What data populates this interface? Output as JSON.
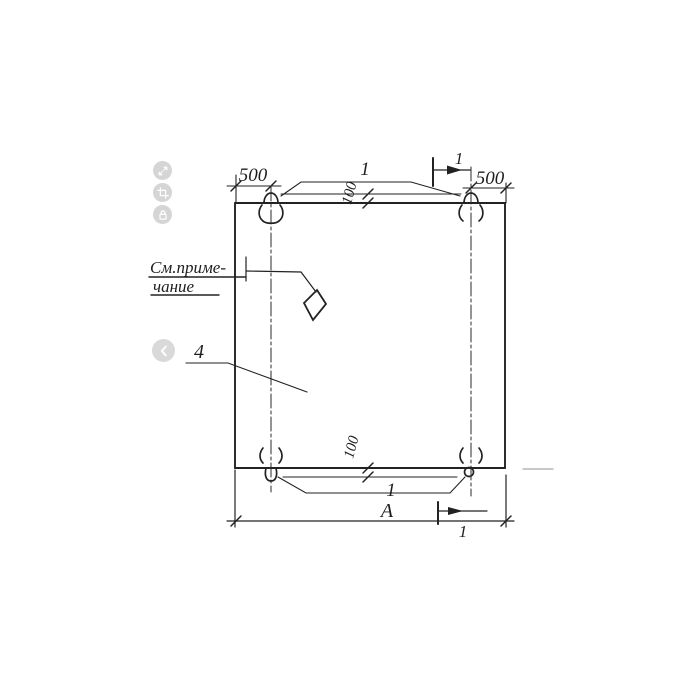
{
  "viewer": {
    "toolbar": {
      "buttons": [
        {
          "name": "expand"
        },
        {
          "name": "crop"
        },
        {
          "name": "lock"
        }
      ]
    },
    "nav": {
      "prev": "chevron-left"
    }
  },
  "drawing": {
    "note": {
      "line1": "См.приме-",
      "line2": "чание"
    },
    "dims": {
      "left_offset": "500",
      "right_offset": "500",
      "top_embed": "100",
      "bottom_embed": "100",
      "width": "А"
    },
    "callouts": {
      "loop_top": "1",
      "loop_bottom": "1",
      "panel": "4"
    },
    "section": {
      "top": "1",
      "bottom": "1"
    }
  },
  "colors": {
    "ink": "#1e1e1e",
    "icon_bg": "#d5d5d5",
    "icon_fg": "#ffffff",
    "faint": "#a8a8a8"
  }
}
